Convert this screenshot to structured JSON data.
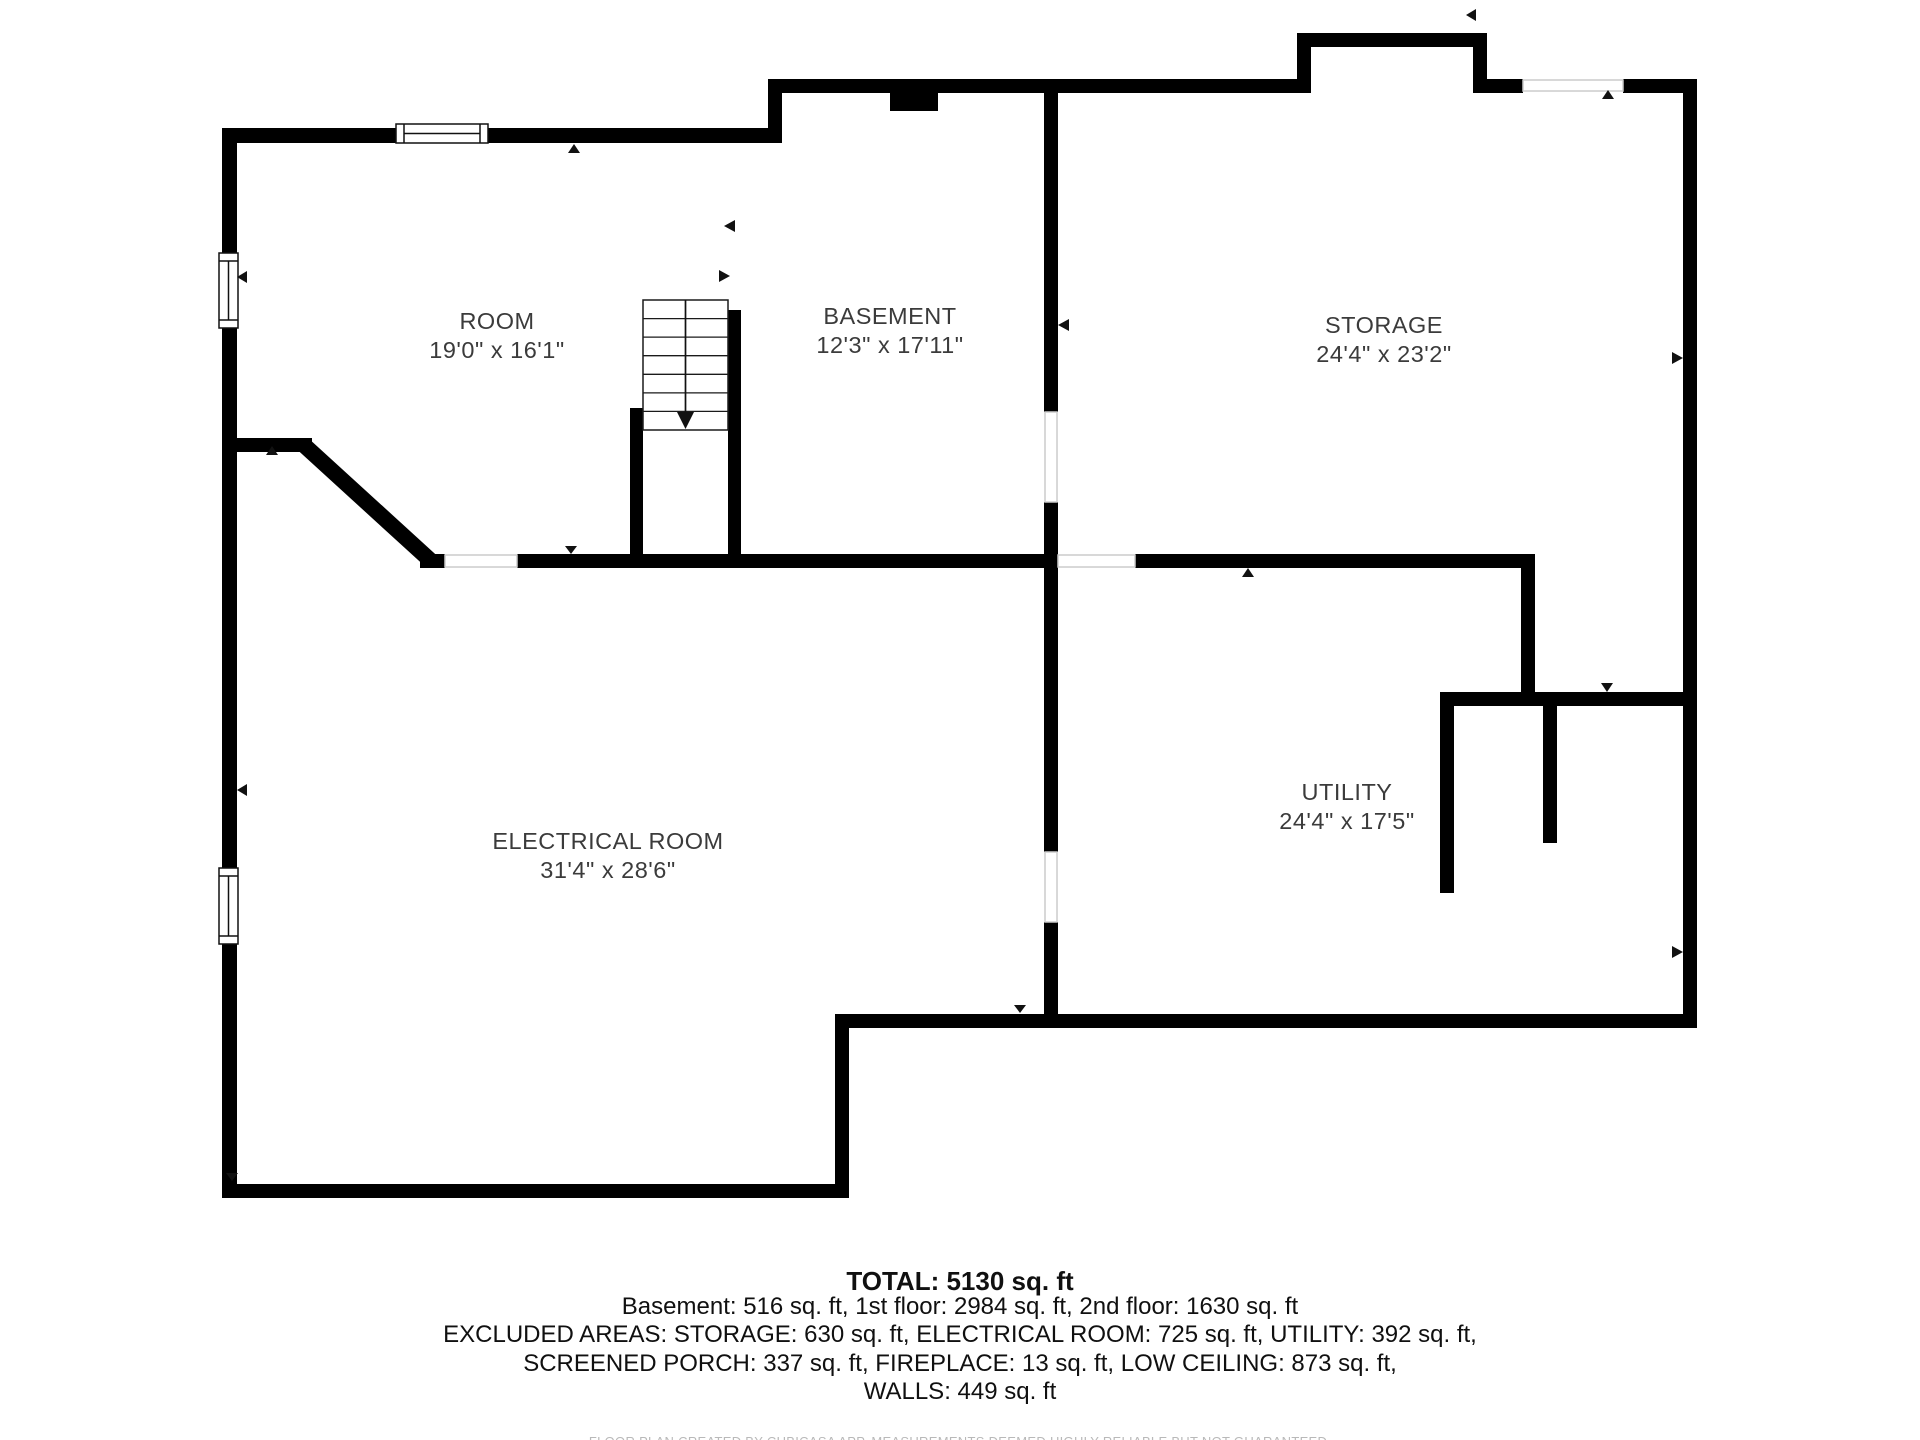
{
  "colors": {
    "wall": "#000000",
    "label_text": "#3b3b3b",
    "summary_text": "#101010",
    "muted_text": "#b9b9b9",
    "opening_line": "#cccccc"
  },
  "plan": {
    "rooms": [
      {
        "name": "ROOM",
        "dims": "19'0\" x 16'1\""
      },
      {
        "name": "BASEMENT",
        "dims": "12'3\" x 17'11\""
      },
      {
        "name": "STORAGE",
        "dims": "24'4\" x 23'2\""
      },
      {
        "name": "ELECTRICAL ROOM",
        "dims": "31'4\" x 28'6\""
      },
      {
        "name": "UTILITY",
        "dims": "24'4\" x 17'5\""
      }
    ]
  },
  "summary": {
    "total": "TOTAL: 5130 sq. ft",
    "lines": [
      "Basement: 516 sq. ft, 1st floor: 2984 sq. ft, 2nd floor: 1630 sq. ft",
      "EXCLUDED AREAS: STORAGE: 630 sq. ft, ELECTRICAL ROOM: 725 sq. ft, UTILITY: 392 sq. ft,",
      "SCREENED PORCH: 337 sq. ft, FIREPLACE: 13 sq. ft, LOW CEILING: 873 sq. ft,",
      "WALLS: 449 sq. ft"
    ],
    "disclaimer": "FLOOR PLAN CREATED BY CUBICASA APP. MEASUREMENTS DEEMED HIGHLY RELIABLE BUT NOT GUARANTEED."
  }
}
